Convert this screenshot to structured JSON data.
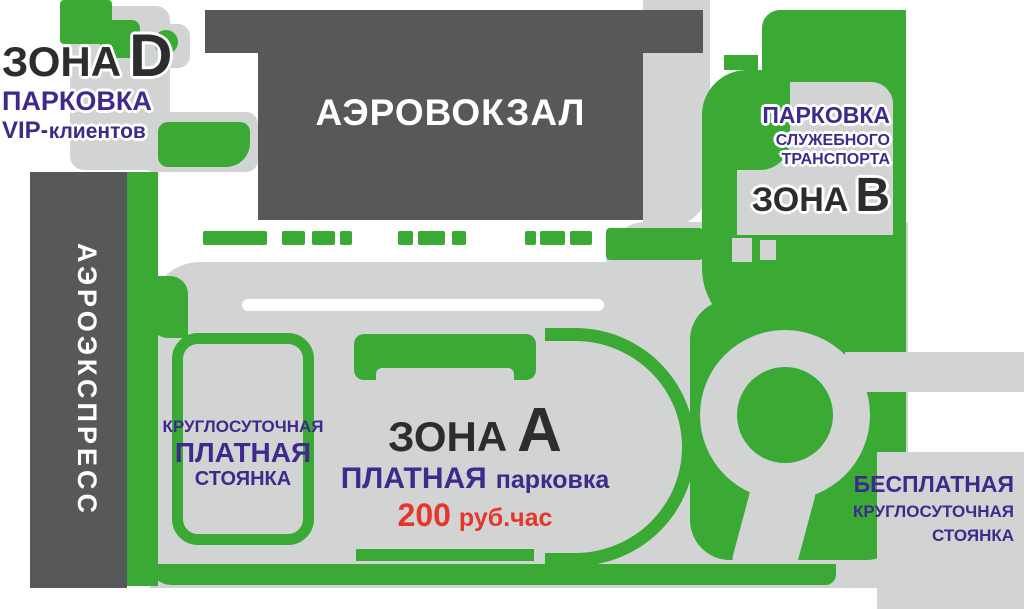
{
  "colors": {
    "green": "#3aaa35",
    "dark_gray": "#57585a",
    "road_gray": "#d2d3d3",
    "purple": "#40298c",
    "red": "#e6362b",
    "black": "#2d2d2f",
    "white": "#ffffff"
  },
  "zone_d": {
    "title_zone": "ЗОНА",
    "title_letter": "D",
    "parking": "ПАРКОВКА",
    "vip_bold": "VIP-",
    "vip_rest": "клиентов"
  },
  "terminal": {
    "name": "АЭРОВОКЗАЛ"
  },
  "aeroexpress": {
    "name": "АЭРОЭКСПРЕСС"
  },
  "zone_b": {
    "parking": "ПАРКОВКА",
    "line2": "СЛУЖЕБНОГО",
    "line3": "ТРАНСПОРТА",
    "title_zone": "ЗОНА",
    "title_letter": "В"
  },
  "paid_daily_lot": {
    "line1": "КРУГЛОСУТОЧНАЯ",
    "line2": "ПЛАТНАЯ",
    "line3": "СТОЯНКА"
  },
  "zone_a": {
    "title_zone": "ЗОНА",
    "title_letter": "А",
    "paid_bold": "ПЛАТНАЯ",
    "paid_rest": "парковка",
    "price_value": "200",
    "price_unit": "руб.час"
  },
  "free_lot": {
    "line1": "БЕСПЛАТНАЯ",
    "line2": "КРУГЛОСУТОЧНАЯ",
    "line3": "СТОЯНКА"
  }
}
